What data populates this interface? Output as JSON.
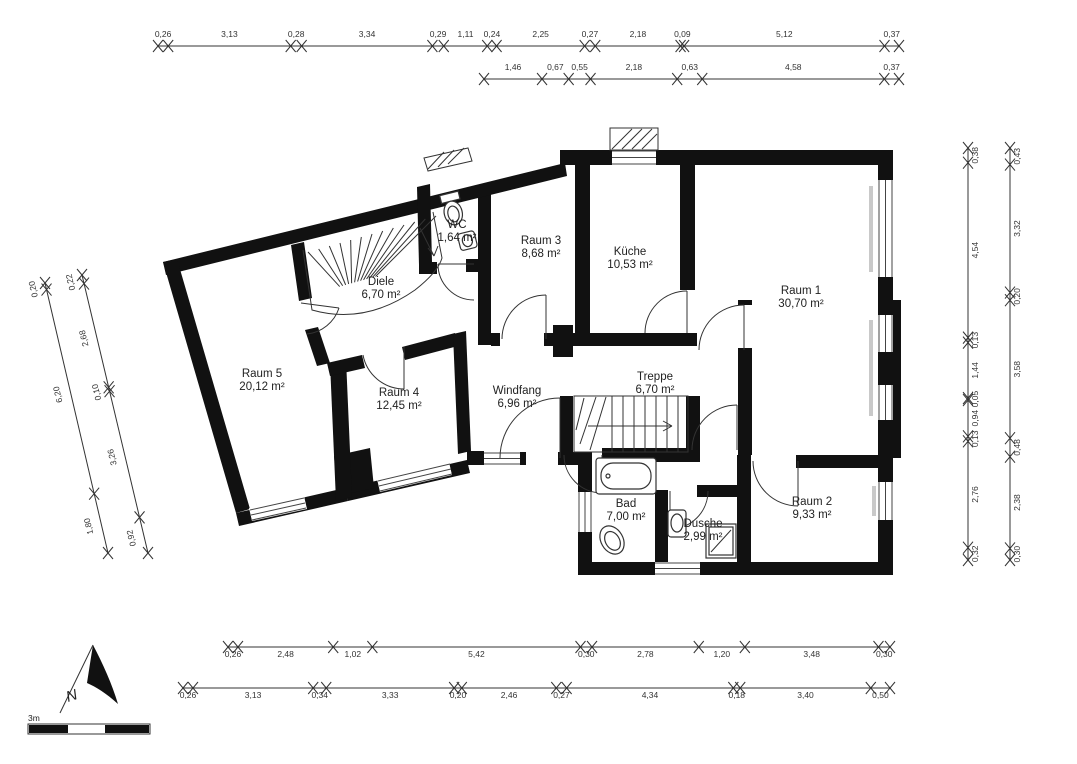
{
  "legend": {
    "north": "N",
    "scale": "3m"
  },
  "rooms": [
    {
      "id": "raum5",
      "name": "Raum 5",
      "area": "20,12 m²",
      "x": 262,
      "y": 377
    },
    {
      "id": "raum4",
      "name": "Raum 4",
      "area": "12,45 m²",
      "x": 399,
      "y": 396
    },
    {
      "id": "diele",
      "name": "Diele",
      "area": "6,70 m²",
      "x": 381,
      "y": 285
    },
    {
      "id": "wc",
      "name": "WC",
      "area": "1,64 m²",
      "x": 457,
      "y": 228
    },
    {
      "id": "raum3",
      "name": "Raum 3",
      "area": "8,68 m²",
      "x": 541,
      "y": 244
    },
    {
      "id": "kueche",
      "name": "Küche",
      "area": "10,53 m²",
      "x": 630,
      "y": 255
    },
    {
      "id": "raum1",
      "name": "Raum 1",
      "area": "30,70 m²",
      "x": 801,
      "y": 294
    },
    {
      "id": "windfang",
      "name": "Windfang",
      "area": "6,96 m²",
      "x": 517,
      "y": 394
    },
    {
      "id": "treppe",
      "name": "Treppe",
      "area": "6,70 m²",
      "x": 655,
      "y": 380
    },
    {
      "id": "bad",
      "name": "Bad",
      "area": "7,00 m²",
      "x": 626,
      "y": 507
    },
    {
      "id": "dusche",
      "name": "Dusche",
      "area": "2,99 m²",
      "x": 703,
      "y": 527
    },
    {
      "id": "raum2",
      "name": "Raum 2",
      "area": "9,33 m²",
      "x": 812,
      "y": 505
    }
  ],
  "dim_chains": {
    "top1": [
      "0,26",
      "3,13",
      "0,28",
      "3,34",
      "0,29",
      "1,11",
      "0,24",
      "2,25",
      "0,27",
      "2,18",
      "0,09",
      "5,12",
      "0,37"
    ],
    "top2": [
      "1,46",
      "0,67",
      "0,55",
      "2,18",
      "0,63",
      "4,58",
      "0,37"
    ],
    "bottom1": [
      "0,26",
      "2,48",
      "1,02",
      "5,42",
      "0,30",
      "2,78",
      "1,20",
      "3,48",
      "0,30"
    ],
    "bottom2": [
      "0,26",
      "3,13",
      "0,34",
      "3,33",
      "0,20",
      "2,46",
      "0,27",
      "4,34",
      "0,18",
      "3,40",
      "0,50"
    ],
    "right_inner": [
      "0,38",
      "4,54",
      "0,13",
      "1,44",
      "0,05",
      "0,94",
      "0,13",
      "2,76",
      "0,32"
    ],
    "right_outer": [
      "0,43",
      "3,32",
      "0,20",
      "3,58",
      "0,48",
      "2,38",
      "0,30"
    ],
    "left_outer": [
      "0,20",
      "6,20",
      "1,80"
    ],
    "left_inner": [
      "0,22",
      "2,68",
      "0,10",
      "3,26",
      "0,92"
    ]
  }
}
